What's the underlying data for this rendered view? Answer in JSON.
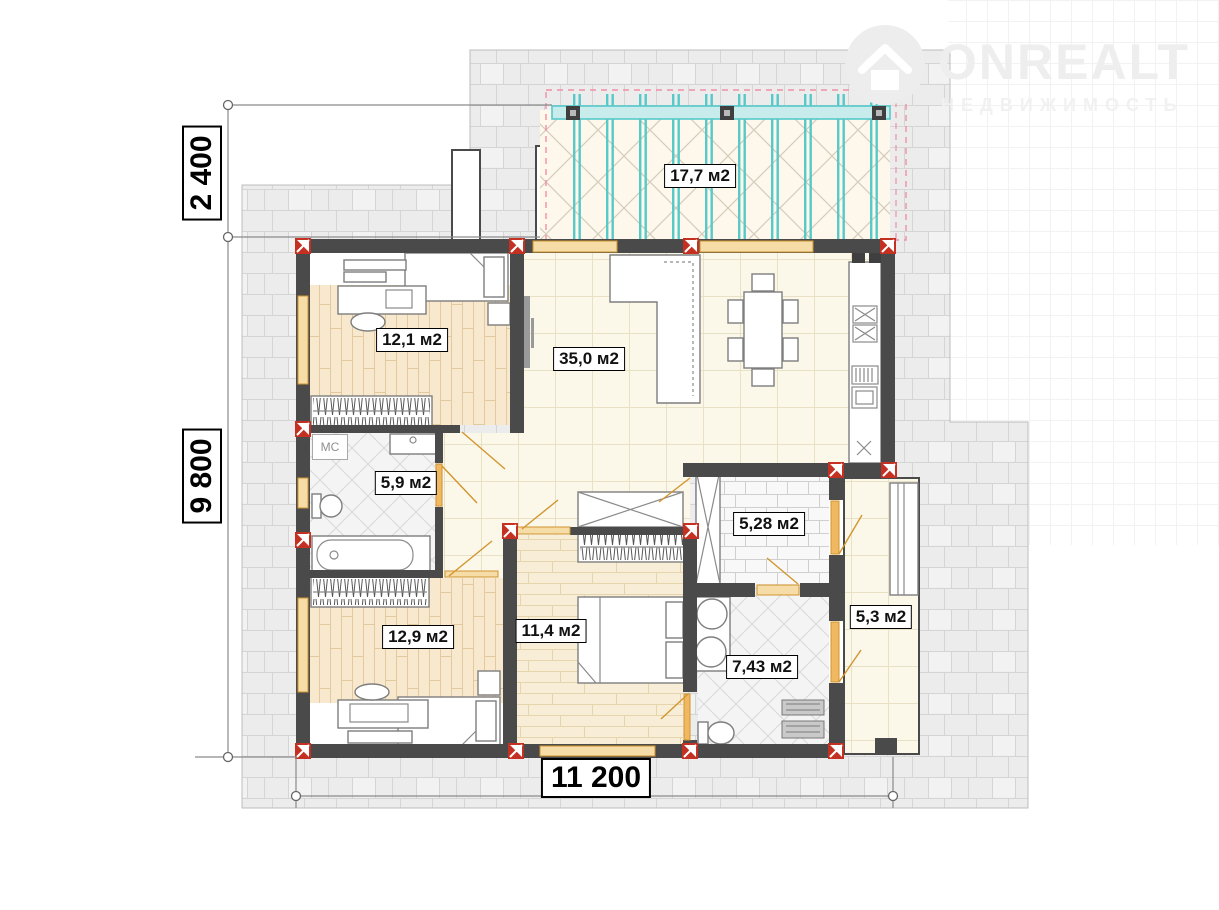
{
  "logo": {
    "brand": "ONREALT",
    "tagline": "НЕДВИЖИМОСТЬ"
  },
  "rooms": [
    {
      "name": "terrace",
      "area_label": "17,7 м2"
    },
    {
      "name": "bedroom-top-left",
      "area_label": "12,1 м2"
    },
    {
      "name": "living-kitchen",
      "area_label": "35,0 м2"
    },
    {
      "name": "bathroom-small",
      "area_label": "5,9 м2"
    },
    {
      "name": "bedroom-bottom-left",
      "area_label": "12,9 м2"
    },
    {
      "name": "bedroom-bottom-center",
      "area_label": "11,4 м2"
    },
    {
      "name": "entry-vestibule",
      "area_label": "5,28 м2"
    },
    {
      "name": "bathroom-large",
      "area_label": "7,43 м2"
    },
    {
      "name": "entry-hall",
      "area_label": "5,3 м2"
    }
  ],
  "dimensions": {
    "top_left_vertical": "2 400",
    "left_vertical": "9 800",
    "bottom_horizontal": "11 200"
  },
  "annotations": {
    "washing_machine": "МС"
  },
  "colors": {
    "wall": "#4a4a4a",
    "marker_red": "#c43022",
    "door_orange": "#d2952f",
    "pergola_teal": "#56c9c9",
    "dashed_pink": "#ef90a5",
    "paving": "#ececec",
    "tile_cream": "#fbf7e9",
    "parquet": "#f8e9ce",
    "watermark_gray": "#eeeeee"
  }
}
